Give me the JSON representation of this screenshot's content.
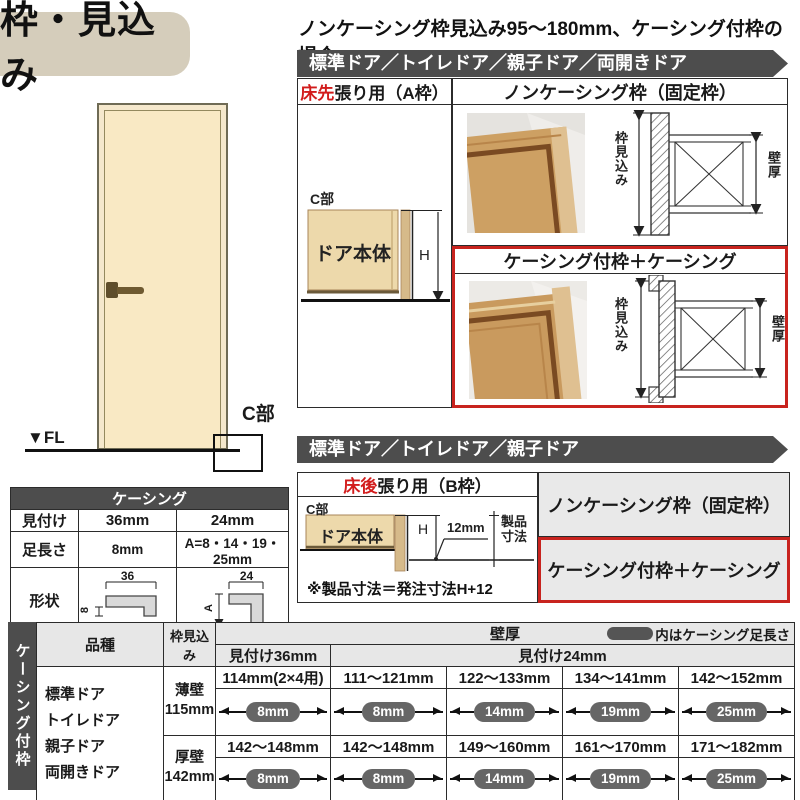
{
  "title": "枠・見込み",
  "subtitle": "ノンケーシング枠見込み95～180mm、ケーシング付枠の場合",
  "illustration": {
    "fl": "▼FL",
    "c": "C部"
  },
  "section1": {
    "bar": "標準ドア／トイレドア／親子ドア／両開きドア",
    "a_frame": {
      "red": "床先",
      "rest": "張り用（A枠）",
      "c": "C部",
      "body": "ドア本体",
      "h": "H"
    },
    "noncasing_title": "ノンケーシング枠（固定枠）",
    "casing_title": "ケーシング付枠＋ケーシング",
    "dim_depth": "枠見込み",
    "dim_wall": "壁厚"
  },
  "section2": {
    "bar": "標準ドア／トイレドア／親子ドア",
    "b_frame": {
      "red": "床後",
      "rest": "張り用（B枠）",
      "c": "C部",
      "body": "ドア本体",
      "h": "H",
      "gap": "12mm",
      "prod1": "製品",
      "prod2": "寸法",
      "note": "※製品寸法＝発注寸法H+12"
    },
    "noncasing_title": "ノンケーシング枠（固定枠）",
    "casing_title": "ケーシング付枠＋ケーシング"
  },
  "casing_table": {
    "title": "ケーシング",
    "row1": {
      "label": "見付け",
      "v36": "36mm",
      "v24": "24mm"
    },
    "row2": {
      "label": "足長さ",
      "v36": "8mm",
      "v24": "A=8・14・19・25mm"
    },
    "row3_label": "形状",
    "dims": {
      "w36": "36",
      "l36": "8",
      "w24": "24",
      "l24": "A"
    }
  },
  "spec_table": {
    "side": "ケーシング付枠",
    "h_kind": "品種",
    "h_depth": "枠見込み",
    "h_wall": "壁厚",
    "legend": "内はケーシング足長さ",
    "h_face36": "見付け36mm",
    "h_face24": "見付け24mm",
    "kinds": [
      "標準ドア",
      "トイレドア",
      "親子ドア",
      "両開きドア"
    ],
    "groups": [
      {
        "wall_type": "薄壁",
        "wall_depth": "115mm",
        "ranges": [
          "114mm(2×4用)",
          "111～121mm",
          "122～133mm",
          "134～141mm",
          "142～152mm"
        ],
        "pills": [
          "8mm",
          "8mm",
          "14mm",
          "19mm",
          "25mm"
        ]
      },
      {
        "wall_type": "厚壁",
        "wall_depth": "142mm",
        "ranges": [
          "142～148mm",
          "142～148mm",
          "149～160mm",
          "161～170mm",
          "171～182mm"
        ],
        "pills": [
          "8mm",
          "8mm",
          "14mm",
          "19mm",
          "25mm"
        ]
      }
    ]
  },
  "colors": {
    "accent_red": "#c8231e",
    "bar_gray": "#4d4d4d",
    "cell_gray": "#e9e9e9",
    "title_beige": "#d5cdbb",
    "pill_gray": "#666666",
    "wood": "#cda063",
    "door_cream": "#f9e9c4"
  }
}
